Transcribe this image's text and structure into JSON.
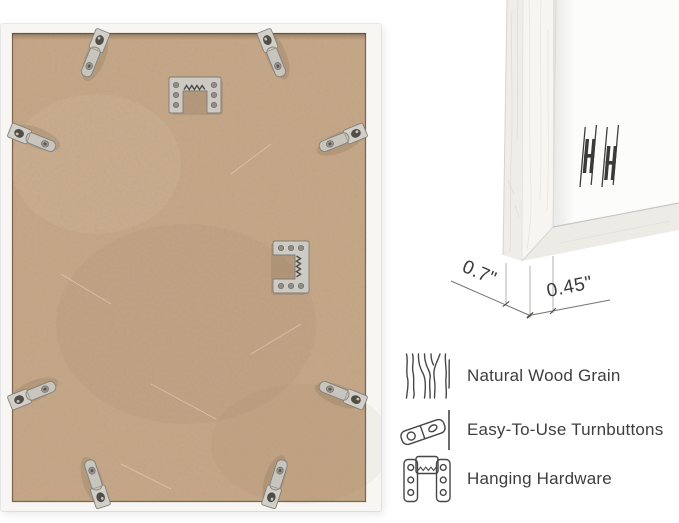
{
  "product_views": {
    "back_view": {
      "name": "frame-back-photo",
      "hardware": {
        "turnbutton_count": 8,
        "hanger_count": 2,
        "icons": [
          "turnbutton-clip-icon",
          "sawtooth-hanger-icon"
        ]
      }
    },
    "corner_view": {
      "name": "frame-corner-photo",
      "depth_label": "0.7\"",
      "width_label": "0.45\"",
      "mat_mark_icon": "hanging-hardware-mark-icon"
    }
  },
  "features": {
    "items": [
      {
        "icon": "wood-grain-icon",
        "label": "Natural Wood Grain"
      },
      {
        "icon": "turnbutton-icon",
        "label": "Easy-To-Use Turnbuttons"
      },
      {
        "icon": "hanging-hardware-icon",
        "label": "Hanging Hardware"
      }
    ]
  },
  "colors": {
    "background": "#ffffff",
    "backing_tan": "#c4a687",
    "frame_white": "#f7f6f3",
    "mat_white": "#fcfcfb",
    "metal_silver": "#c9c6bf",
    "metal_dark": "#514e48",
    "text_dark": "#3e3e3e",
    "icon_stroke": "#474747",
    "dimension_line": "#8c8c8c"
  }
}
